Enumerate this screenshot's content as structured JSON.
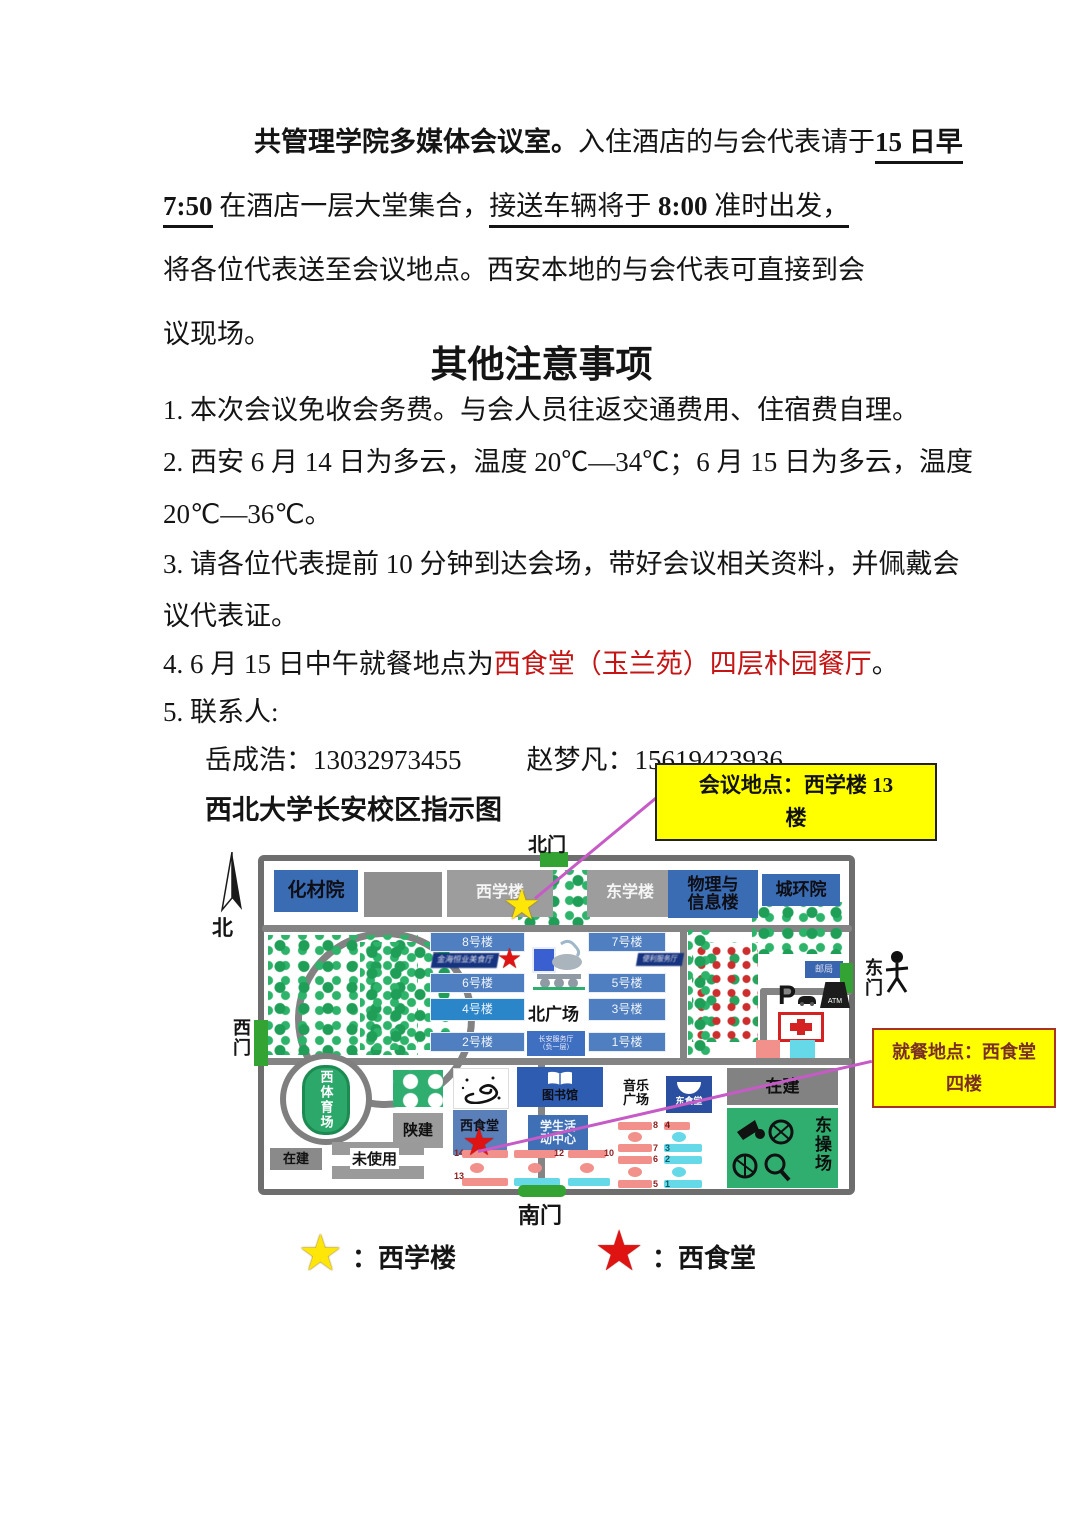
{
  "doc": {
    "p1_l1_a": "共管理学院多媒体会议室。",
    "p1_l1_b": "入住酒店的与会代表请于",
    "p1_l1_c": "15 日早",
    "p1_l2_a": "7:50",
    "p1_l2_b": " 在酒店一层大堂集合，",
    "p1_l2_c": "接送车辆将于 ",
    "p1_l2_d": "8:00",
    "p1_l2_e": " 准时出发，",
    "p1_l3": "将各位代表送至会议地点。西安本地的与会代表可直接到会",
    "p1_l4": "议现场。",
    "heading": "其他注意事项",
    "item1": "1. 本次会议免收会务费。与会人员往返交通费用、住宿费自理。",
    "item2_l1": "2. 西安 6 月 14 日为多云，温度 20℃—34℃；6 月 15 日为多云，温度",
    "item2_l2": "20℃—36℃。",
    "item3_l1": "3. 请各位代表提前 10 分钟到达会场，带好会议相关资料，并佩戴会",
    "item3_l2": "议代表证。",
    "item4_a": "4. 6 月 15 日中午就餐地点为",
    "item4_b": "西食堂（玉兰苑）四层朴园餐厅",
    "item4_c": "。",
    "item5": "5. 联系人:",
    "contact1": "岳成浩：13032973455",
    "contact2": "赵梦凡：15619423936",
    "map_title": "西北大学长安校区指示图"
  },
  "callouts": {
    "meeting_l1": "会议地点：西学楼 13",
    "meeting_l2": "楼",
    "dining_l1": "就餐地点：西食堂",
    "dining_l2": "四楼"
  },
  "map": {
    "compass": "北",
    "gates": {
      "north": "北门",
      "south": "南门",
      "east": "东门",
      "west": "西门"
    },
    "chemical": "化材院",
    "west_school": "西学楼",
    "east_school": "东学楼",
    "physics_l1": "物理与",
    "physics_l2": "信息楼",
    "urban": "城环院",
    "b8": "8号楼",
    "b7": "7号楼",
    "b6": "6号楼",
    "b5": "5号楼",
    "b4": "4号楼",
    "b3": "3号楼",
    "b2": "2号楼",
    "b1": "1号楼",
    "banner_left": "金海恒业美食厅",
    "banner_right": "便利服务厅",
    "service_l1": "长安服务厅",
    "service_l2": "（负一层）",
    "north_plaza": "北广场",
    "post_office": "邮局",
    "parking": "P",
    "atm": "ATM",
    "west_stadium": "西体育场",
    "shaanjian": "陕建",
    "west_canteen": "西食堂",
    "library": "图书馆",
    "student_center_l1": "学生活",
    "student_center_l2": "动中心",
    "music_l1": "音乐",
    "music_l2": "广场",
    "east_canteen": "东食堂",
    "under_construction_tr": "在建",
    "under_construction_bl": "在建",
    "east_playground": "东操场",
    "unused": "未使用",
    "dorms": [
      "14",
      "13",
      "12",
      "10",
      "8",
      "7",
      "4",
      "3",
      "6",
      "5",
      "2",
      "1"
    ]
  },
  "legend": {
    "yellow_label": "：西学楼",
    "red_label": "：西食堂"
  },
  "icons": {
    "star": "★"
  },
  "colors": {
    "callout_yellow": "#ffff00",
    "connector_magenta": "#c65ac6",
    "building_blue": "#3a6cb4",
    "teaching_blue": "#4f7fc0",
    "green_field": "#2fae70",
    "dorm_pink": "#f2908b",
    "dorm_cyan": "#65d9e8",
    "highlight_red": "#c41414"
  }
}
